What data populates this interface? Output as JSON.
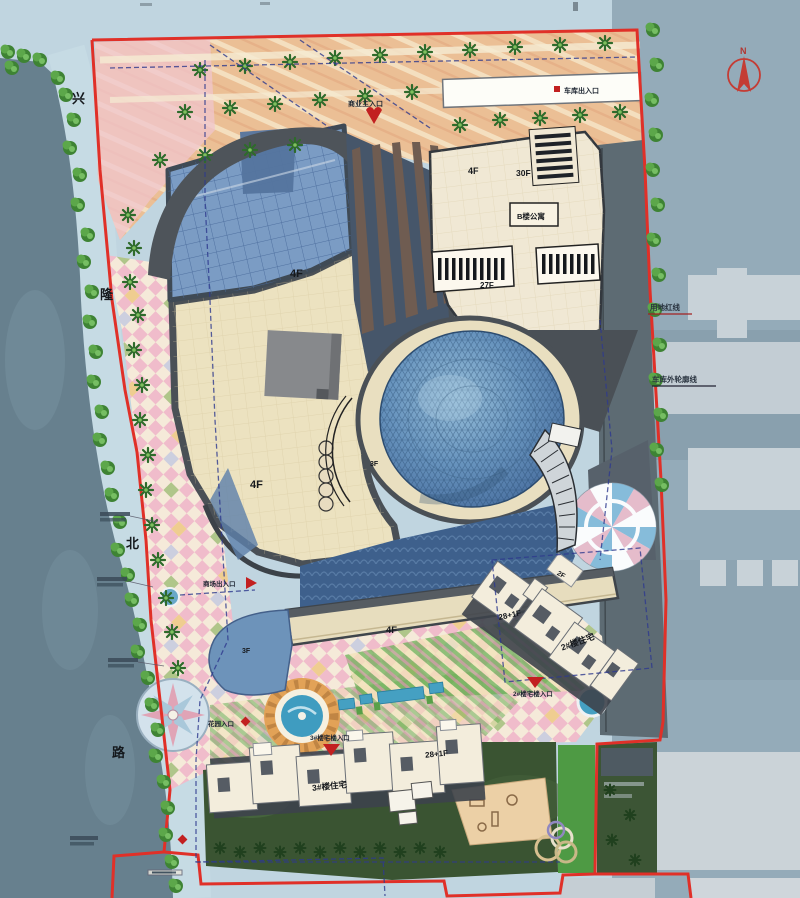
{
  "road": {
    "chars": [
      "兴",
      "隆",
      "北",
      "路"
    ]
  },
  "north_arrow": {
    "label": "N"
  },
  "lines": {
    "site_boundary": "用地红线",
    "garage_outline": "车库外轮廓线"
  },
  "entrances": {
    "commercial_main": "商业主入口",
    "garage": "车库出入口",
    "mall_side": "商场出入口",
    "garden": "花园入口",
    "res3": "3#楼宅楼入口",
    "res2": "2#楼宅楼入口"
  },
  "buildings": {
    "mall_north": "4F",
    "mall_southwest": "4F",
    "mall_annex": "3F",
    "podium": "3F",
    "retail_strip": "4F",
    "ne_block": "4F",
    "tower": "30F",
    "tower2": "27F",
    "apartment": "B楼公寓",
    "small_block": "2F",
    "res2_floors": "28+1F",
    "res2_name": "2#楼住宅",
    "res3_floors": "28+1F",
    "res3_name": "3#楼住宅"
  },
  "colors": {
    "boundary_red": "#e03028",
    "utility_blue": "#2e3a8e",
    "water_dark": "#67808e",
    "water_light": "#c0d5e0",
    "roof_cream": "#ece2c0",
    "glass_blue": "#7b9cc4",
    "dome_blue": "#5e8ab4",
    "parking_tan": "#ebbf95",
    "lawn_dark": "#3a5432",
    "marker_red": "#c22020"
  }
}
